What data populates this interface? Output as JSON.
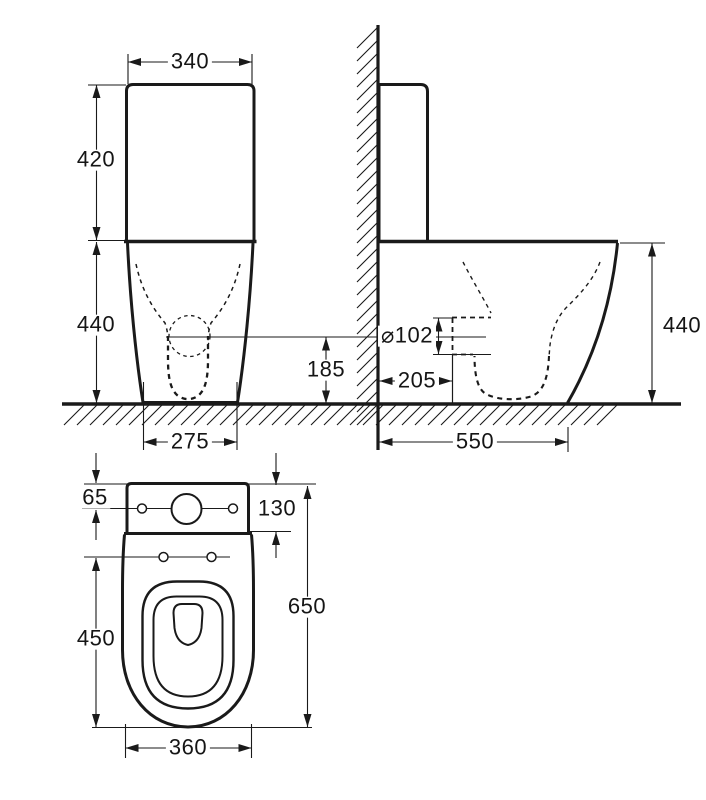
{
  "drawing_type": "toilet-installation-dimension-diagram",
  "line_color": "#1a1a1a",
  "background_color": "#ffffff",
  "dims": {
    "front_tank_width": "340",
    "front_tank_height": "420",
    "front_bowl_height": "440",
    "front_base_width": "275",
    "front_outlet_height": "185",
    "side_outlet_diameter": "⌀102",
    "side_outlet_setout": "205",
    "side_depth": "550",
    "side_height": "440",
    "top_tank_offset": "65",
    "top_tank_depth": "130",
    "top_overall_length": "650",
    "top_bowl_length": "450",
    "top_bowl_width": "360"
  }
}
